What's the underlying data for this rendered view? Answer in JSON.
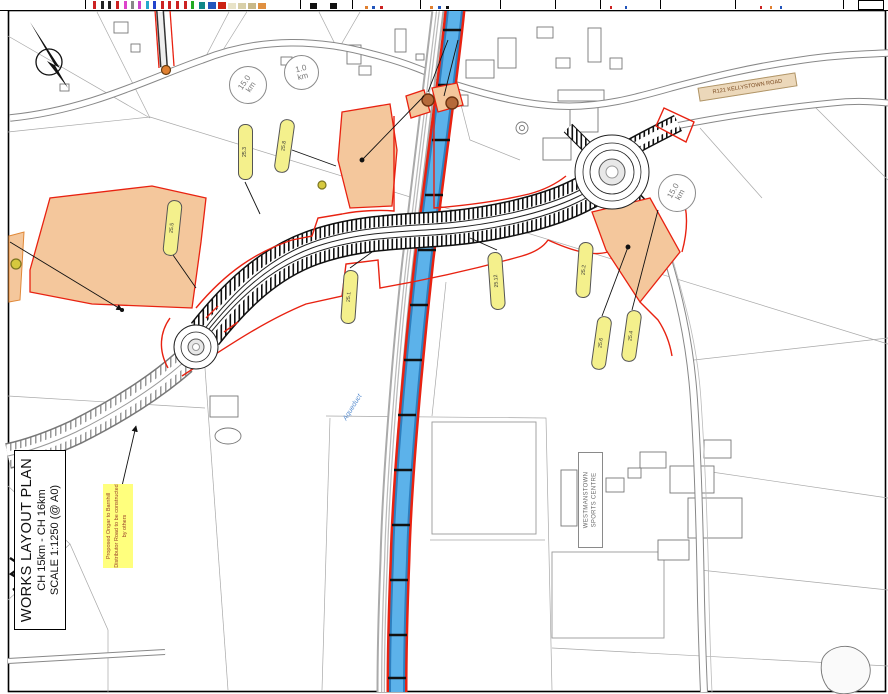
{
  "title_block": {
    "line1": "WORKS LAYOUT PLAN",
    "line2": "CH 15km - CH 16km",
    "line3": "SCALE 1:1250 (@ A0)"
  },
  "note": {
    "text": "Proposed Ongar to Barnhill Distributor Road to be constructed by others"
  },
  "labels": {
    "road_name": "R121 KELLYSTOWN ROAD",
    "sports_centre_line1": "WESTMANSTOWN",
    "sports_centre_line2": "SPORTS CENTRE",
    "aqueduct": "Aqueduct"
  },
  "chainage_markers": [
    {
      "value": "15.0",
      "unit": "km"
    },
    {
      "value": "1.0",
      "unit": "km"
    },
    {
      "value": "15.0",
      "unit": "km"
    }
  ],
  "plot_refs": [
    {
      "label": "25.3"
    },
    {
      "label": "25.8"
    },
    {
      "label": "25.5"
    },
    {
      "label": "25.1"
    },
    {
      "label": "25.12"
    },
    {
      "label": "25.2"
    },
    {
      "label": "25.6"
    },
    {
      "label": "25.4"
    }
  ],
  "colors": {
    "works_boundary_red": "#e82211",
    "canal_blue": "#5cb2ea",
    "canal_blue_dark": "#2d7fbf",
    "plot_fill_orange": "#f4c79c",
    "ref_pill_yellow": "#f4f08c",
    "note_yellow": "#ffff7d",
    "road_grey": "#888888",
    "hatch_black": "#111111"
  },
  "legend_strip": {
    "dividers": [
      85,
      300,
      352,
      420,
      500,
      555,
      600,
      660,
      735,
      843
    ],
    "swatches": [
      {
        "x": 93,
        "w": 3,
        "h": 8,
        "c": "#cc2222"
      },
      {
        "x": 101,
        "w": 3,
        "h": 8,
        "c": "#222222"
      },
      {
        "x": 108,
        "w": 3,
        "h": 8,
        "c": "#222222"
      },
      {
        "x": 116,
        "w": 3,
        "h": 8,
        "c": "#cc2222"
      },
      {
        "x": 124,
        "w": 3,
        "h": 8,
        "c": "#dd44cc"
      },
      {
        "x": 131,
        "w": 3,
        "h": 8,
        "c": "#888888"
      },
      {
        "x": 138,
        "w": 3,
        "h": 8,
        "c": "#cc44cc"
      },
      {
        "x": 146,
        "w": 3,
        "h": 8,
        "c": "#22aacc"
      },
      {
        "x": 153,
        "w": 3,
        "h": 8,
        "c": "#2244cc"
      },
      {
        "x": 161,
        "w": 3,
        "h": 8,
        "c": "#cc2222"
      },
      {
        "x": 168,
        "w": 3,
        "h": 8,
        "c": "#cc2222"
      },
      {
        "x": 176,
        "w": 3,
        "h": 8,
        "c": "#cc2222"
      },
      {
        "x": 184,
        "w": 3,
        "h": 8,
        "c": "#cc2222"
      },
      {
        "x": 191,
        "w": 3,
        "h": 8,
        "c": "#22aa22"
      },
      {
        "x": 199,
        "w": 6,
        "h": 7,
        "c": "#118888"
      },
      {
        "x": 208,
        "w": 8,
        "h": 7,
        "c": "#2255bb"
      },
      {
        "x": 218,
        "w": 8,
        "h": 7,
        "c": "#cc2211"
      },
      {
        "x": 228,
        "w": 8,
        "h": 6,
        "c": "#e8e3c8"
      },
      {
        "x": 238,
        "w": 8,
        "h": 6,
        "c": "#d8cfa8"
      },
      {
        "x": 248,
        "w": 8,
        "h": 6,
        "c": "#c8b888"
      },
      {
        "x": 258,
        "w": 8,
        "h": 6,
        "c": "#e09040"
      },
      {
        "x": 310,
        "w": 7,
        "h": 6,
        "c": "#111111"
      },
      {
        "x": 330,
        "w": 7,
        "h": 6,
        "c": "#111111"
      },
      {
        "x": 365,
        "w": 3,
        "h": 3,
        "c": "#e08030"
      },
      {
        "x": 372,
        "w": 3,
        "h": 3,
        "c": "#2255bb"
      },
      {
        "x": 380,
        "w": 3,
        "h": 3,
        "c": "#cc2222"
      },
      {
        "x": 430,
        "w": 3,
        "h": 3,
        "c": "#e08030"
      },
      {
        "x": 438,
        "w": 3,
        "h": 3,
        "c": "#2255bb"
      },
      {
        "x": 446,
        "w": 3,
        "h": 3,
        "c": "#111111"
      },
      {
        "x": 610,
        "w": 2,
        "h": 3,
        "c": "#cc2222"
      },
      {
        "x": 625,
        "w": 2,
        "h": 3,
        "c": "#2255bb"
      },
      {
        "x": 760,
        "w": 2,
        "h": 3,
        "c": "#cc2222"
      },
      {
        "x": 770,
        "w": 2,
        "h": 3,
        "c": "#e08030"
      },
      {
        "x": 780,
        "w": 2,
        "h": 3,
        "c": "#2255bb"
      }
    ]
  }
}
